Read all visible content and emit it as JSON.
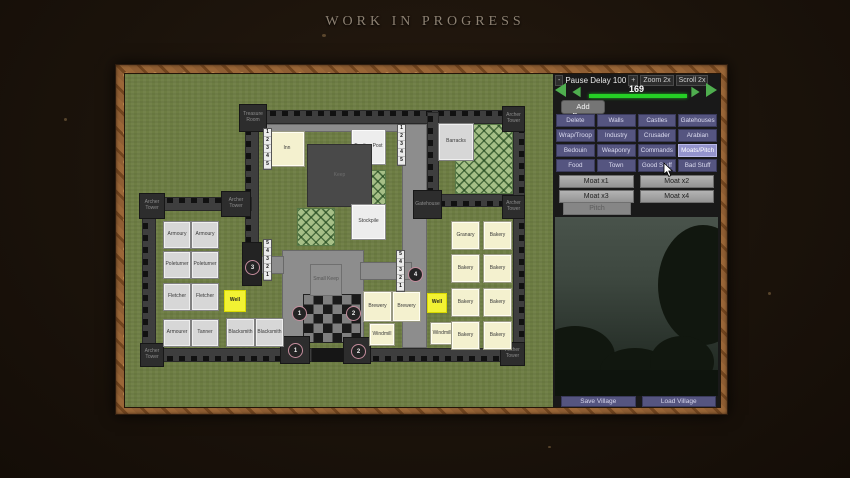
{
  "title": "WORK IN PROGRESS",
  "colors": {
    "grass": "#6d7d43",
    "wall": "#3e3e3e",
    "accent_green": "#25cf25",
    "button_purple": "#555580",
    "button_purple_active": "#9494cc",
    "frame_wood": "#8f5e33",
    "building_cream": "#f4f1cf",
    "well_yellow": "#f2f233"
  },
  "panel": {
    "header": {
      "minus": "-",
      "label": "Pause Delay 100",
      "plus": "+",
      "zoom": "Zoom 2x",
      "scroll": "Scroll 2x"
    },
    "slider": {
      "value": "169"
    },
    "add_pause_label": "Add Pause",
    "categories": [
      {
        "label": "Delete"
      },
      {
        "label": "Walls"
      },
      {
        "label": "Castles"
      },
      {
        "label": "Gatehouses"
      },
      {
        "label": "Wrap/Troop"
      },
      {
        "label": "Industry"
      },
      {
        "label": "Crusader"
      },
      {
        "label": "Arabian"
      },
      {
        "label": "Bedouin"
      },
      {
        "label": "Weaponry"
      },
      {
        "label": "Commands"
      },
      {
        "label": "Moats/Pitch",
        "active": true
      },
      {
        "label": "Food"
      },
      {
        "label": "Town"
      },
      {
        "label": "Good Stuff"
      },
      {
        "label": "Bad Stuff"
      }
    ],
    "moat_buttons": [
      "Moat x1",
      "Moat x2",
      "Moat x3",
      "Moat x4"
    ],
    "pitch_label": "Pitch",
    "footer_buttons": [
      "Save Village",
      "Load Village"
    ]
  },
  "map": {
    "walls": [
      {
        "x": 120,
        "y": 36,
        "w": 280,
        "h": 14,
        "cren": "top"
      },
      {
        "x": 120,
        "y": 36,
        "w": 14,
        "h": 134,
        "cren": "left"
      },
      {
        "x": 302,
        "y": 38,
        "w": 12,
        "h": 95,
        "cren": "left"
      },
      {
        "x": 313,
        "y": 120,
        "w": 87,
        "h": 13,
        "cren": "bottom"
      },
      {
        "x": 388,
        "y": 36,
        "w": 12,
        "h": 252,
        "cren": "right"
      },
      {
        "x": 17,
        "y": 123,
        "w": 110,
        "h": 14,
        "cren": "top"
      },
      {
        "x": 17,
        "y": 123,
        "w": 14,
        "h": 165,
        "cren": "left"
      },
      {
        "x": 17,
        "y": 274,
        "w": 170,
        "h": 14,
        "cren": "bottom"
      },
      {
        "x": 235,
        "y": 274,
        "w": 165,
        "h": 14,
        "cren": "bottom"
      }
    ],
    "roads": [
      {
        "x": 134,
        "y": 50,
        "w": 146,
        "h": 8
      },
      {
        "x": 277,
        "y": 50,
        "w": 25,
        "h": 224
      },
      {
        "x": 157,
        "y": 176,
        "w": 82,
        "h": 92
      },
      {
        "x": 122,
        "y": 182,
        "w": 37,
        "h": 18
      },
      {
        "x": 235,
        "y": 188,
        "w": 52,
        "h": 18
      },
      {
        "x": 179,
        "y": 274,
        "w": 56,
        "h": 14,
        "dark": true
      }
    ],
    "checker": {
      "x": 179,
      "y": 221,
      "w": 56,
      "h": 47
    },
    "farms": [
      {
        "x": 172,
        "y": 134,
        "w": 38,
        "h": 38
      },
      {
        "x": 225,
        "y": 96,
        "w": 36,
        "h": 36
      },
      {
        "x": 330,
        "y": 50,
        "w": 58,
        "h": 70
      }
    ],
    "towers": [
      {
        "x": 114,
        "y": 30,
        "w": 28,
        "h": 28,
        "label": "Treasure Room"
      },
      {
        "x": 14,
        "y": 119,
        "w": 26,
        "h": 26,
        "label": "Archer Tower"
      },
      {
        "x": 96,
        "y": 117,
        "w": 30,
        "h": 26,
        "label": "Archer Tower"
      },
      {
        "x": 288,
        "y": 116,
        "w": 29,
        "h": 29,
        "label": "Gatehouse"
      },
      {
        "x": 377,
        "y": 32,
        "w": 23,
        "h": 26,
        "label": "Archer Tower"
      },
      {
        "x": 377,
        "y": 121,
        "w": 23,
        "h": 24,
        "label": "Archer Tower"
      },
      {
        "x": 375,
        "y": 268,
        "w": 25,
        "h": 24,
        "label": "Archer Tower"
      },
      {
        "x": 155,
        "y": 262,
        "w": 30,
        "h": 28,
        "label": ""
      },
      {
        "x": 218,
        "y": 263,
        "w": 28,
        "h": 27,
        "label": ""
      },
      {
        "x": 15,
        "y": 269,
        "w": 24,
        "h": 24,
        "label": "Archer Tower"
      },
      {
        "x": 117,
        "y": 168,
        "w": 20,
        "h": 44,
        "label": "",
        "gate": true
      }
    ],
    "buildings": [
      {
        "x": 39,
        "y": 148,
        "w": 26,
        "h": 26,
        "t": "light",
        "l": "Armoury"
      },
      {
        "x": 67,
        "y": 148,
        "w": 26,
        "h": 26,
        "t": "light",
        "l": "Armoury"
      },
      {
        "x": 39,
        "y": 178,
        "w": 26,
        "h": 26,
        "t": "light",
        "l": "Poleturner"
      },
      {
        "x": 67,
        "y": 178,
        "w": 26,
        "h": 26,
        "t": "light",
        "l": "Poleturner"
      },
      {
        "x": 39,
        "y": 210,
        "w": 26,
        "h": 26,
        "t": "light",
        "l": "Fletcher"
      },
      {
        "x": 67,
        "y": 210,
        "w": 26,
        "h": 26,
        "t": "light",
        "l": "Fletcher"
      },
      {
        "x": 39,
        "y": 246,
        "w": 26,
        "h": 26,
        "t": "light",
        "l": "Armourer"
      },
      {
        "x": 67,
        "y": 246,
        "w": 26,
        "h": 26,
        "t": "light",
        "l": "Tanner"
      },
      {
        "x": 102,
        "y": 245,
        "w": 27,
        "h": 27,
        "t": "light",
        "l": "Blacksmith"
      },
      {
        "x": 131,
        "y": 245,
        "w": 27,
        "h": 27,
        "t": "light",
        "l": "Blacksmith"
      },
      {
        "x": 99,
        "y": 216,
        "w": 22,
        "h": 22,
        "t": "yellow",
        "l": "Well"
      },
      {
        "x": 145,
        "y": 58,
        "w": 34,
        "h": 34,
        "t": "cream",
        "l": "Inn"
      },
      {
        "x": 227,
        "y": 56,
        "w": 33,
        "h": 34,
        "t": "white",
        "l": "Trading Post"
      },
      {
        "x": 182,
        "y": 70,
        "w": 65,
        "h": 63,
        "t": "dark",
        "l": "Keep"
      },
      {
        "x": 227,
        "y": 131,
        "w": 33,
        "h": 34,
        "t": "white",
        "l": "Stockpile"
      },
      {
        "x": 314,
        "y": 50,
        "w": 34,
        "h": 36,
        "t": "light",
        "l": "Barracks"
      },
      {
        "x": 185,
        "y": 190,
        "w": 32,
        "h": 32,
        "t": "gray",
        "l": "Small Keep"
      },
      {
        "x": 239,
        "y": 218,
        "w": 27,
        "h": 29,
        "t": "cream",
        "l": "Brewery"
      },
      {
        "x": 268,
        "y": 218,
        "w": 27,
        "h": 29,
        "t": "cream",
        "l": "Brewery"
      },
      {
        "x": 302,
        "y": 219,
        "w": 20,
        "h": 20,
        "t": "yellow",
        "l": "Well"
      },
      {
        "x": 245,
        "y": 250,
        "w": 24,
        "h": 21,
        "t": "cream",
        "l": "Windmill"
      },
      {
        "x": 306,
        "y": 249,
        "w": 22,
        "h": 21,
        "t": "cream",
        "l": "Windmill"
      },
      {
        "x": 327,
        "y": 148,
        "w": 27,
        "h": 27,
        "t": "cream",
        "l": "Granary"
      },
      {
        "x": 359,
        "y": 148,
        "w": 27,
        "h": 27,
        "t": "cream",
        "l": "Bakery"
      },
      {
        "x": 327,
        "y": 181,
        "w": 27,
        "h": 27,
        "t": "cream",
        "l": "Bakery"
      },
      {
        "x": 359,
        "y": 181,
        "w": 27,
        "h": 27,
        "t": "cream",
        "l": "Bakery"
      },
      {
        "x": 327,
        "y": 215,
        "w": 27,
        "h": 27,
        "t": "cream",
        "l": "Bakery"
      },
      {
        "x": 359,
        "y": 215,
        "w": 27,
        "h": 27,
        "t": "cream",
        "l": "Bakery"
      },
      {
        "x": 327,
        "y": 248,
        "w": 27,
        "h": 27,
        "t": "cream",
        "l": "Bakery"
      },
      {
        "x": 359,
        "y": 248,
        "w": 27,
        "h": 27,
        "t": "cream",
        "l": "Bakery"
      }
    ],
    "strips": [
      {
        "x": 139,
        "y": 55,
        "d": "12345"
      },
      {
        "x": 273,
        "y": 51,
        "d": "12345"
      },
      {
        "x": 139,
        "y": 166,
        "d": "54321"
      },
      {
        "x": 272,
        "y": 177,
        "d": "54321"
      }
    ],
    "badges": [
      {
        "x": 167,
        "y": 232,
        "n": "1"
      },
      {
        "x": 221,
        "y": 232,
        "n": "2"
      },
      {
        "x": 163,
        "y": 269,
        "n": "1"
      },
      {
        "x": 226,
        "y": 270,
        "n": "2"
      },
      {
        "x": 283,
        "y": 193,
        "n": "4"
      },
      {
        "x": 120,
        "y": 186,
        "n": "3"
      }
    ]
  }
}
